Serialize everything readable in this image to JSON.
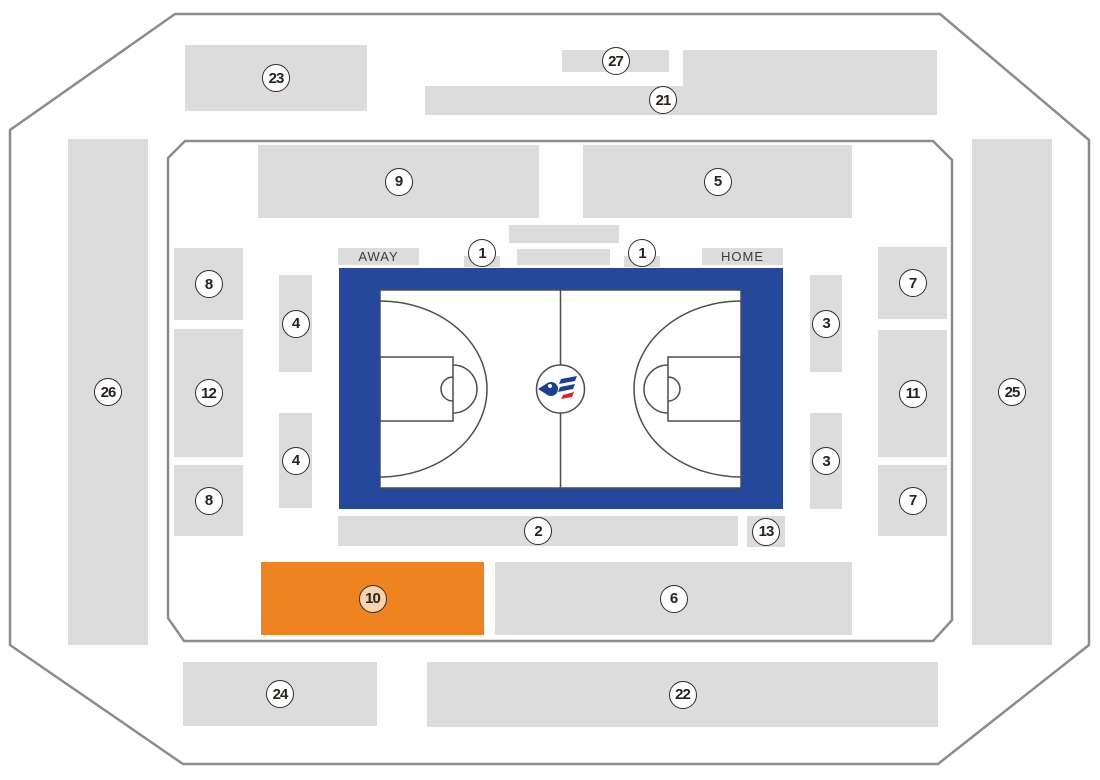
{
  "title": "Arena seating map",
  "labels": {
    "away": "AWAY",
    "home": "HOME"
  },
  "colors": {
    "section": "#dcdcdc",
    "highlight": "#ef8320",
    "boundary": "#8c8c8c",
    "court_border": "#26489c",
    "court_line": "#4d4d4d",
    "badge_border": "#362b27",
    "badge_text": "#2b211e",
    "badge_fill": "#ffffff",
    "badge_fill_highlight": "#f6d4ae",
    "tab_text": "#3b3b3b",
    "logo_blue": "#1c3f94",
    "logo_red": "#d5232e"
  },
  "sections": [
    {
      "id": "23",
      "label": "23",
      "x": 185,
      "y": 45,
      "w": 182,
      "h": 66
    },
    {
      "id": "27",
      "label": "27",
      "x": 562,
      "y": 50,
      "w": 107,
      "h": 22
    },
    {
      "id": "deck-top-right",
      "label": null,
      "x": 683,
      "y": 50,
      "w": 254,
      "h": 36
    },
    {
      "id": "21",
      "label": "21",
      "x": 425,
      "y": 86,
      "w": 512,
      "h": 29,
      "lx": 663,
      "ly": 100
    },
    {
      "id": "9",
      "label": "9",
      "x": 258,
      "y": 145,
      "w": 281,
      "h": 73
    },
    {
      "id": "5",
      "label": "5",
      "x": 583,
      "y": 145,
      "w": 269,
      "h": 73
    },
    {
      "id": "26",
      "label": "26",
      "x": 68,
      "y": 139,
      "w": 80,
      "h": 506
    },
    {
      "id": "25",
      "label": "25",
      "x": 972,
      "y": 139,
      "w": 80,
      "h": 506
    },
    {
      "id": "8-upper",
      "label": "8",
      "x": 174,
      "y": 248,
      "w": 69,
      "h": 72
    },
    {
      "id": "12",
      "label": "12",
      "x": 174,
      "y": 329,
      "w": 69,
      "h": 128
    },
    {
      "id": "8-lower",
      "label": "8",
      "x": 174,
      "y": 465,
      "w": 69,
      "h": 71
    },
    {
      "id": "4-upper",
      "label": "4",
      "x": 279,
      "y": 275,
      "w": 33,
      "h": 97
    },
    {
      "id": "4-lower",
      "label": "4",
      "x": 279,
      "y": 413,
      "w": 33,
      "h": 95
    },
    {
      "id": "3-upper",
      "label": "3",
      "x": 810,
      "y": 275,
      "w": 32,
      "h": 97
    },
    {
      "id": "3-lower",
      "label": "3",
      "x": 810,
      "y": 413,
      "w": 32,
      "h": 96
    },
    {
      "id": "7-upper",
      "label": "7",
      "x": 878,
      "y": 247,
      "w": 69,
      "h": 72
    },
    {
      "id": "11",
      "label": "11",
      "x": 878,
      "y": 330,
      "w": 69,
      "h": 127
    },
    {
      "id": "7-lower",
      "label": "7",
      "x": 878,
      "y": 465,
      "w": 69,
      "h": 71
    },
    {
      "id": "bar-upper-center",
      "label": null,
      "x": 509,
      "y": 225,
      "w": 110,
      "h": 18
    },
    {
      "id": "bar-lower-center",
      "label": null,
      "x": 517,
      "y": 249,
      "w": 93,
      "h": 16
    },
    {
      "id": "1-away",
      "label": "1",
      "x": 464,
      "y": 256,
      "w": 36,
      "h": 11,
      "ly": 253
    },
    {
      "id": "1-home",
      "label": "1",
      "x": 624,
      "y": 256,
      "w": 36,
      "h": 11,
      "ly": 253
    },
    {
      "id": "2",
      "label": "2",
      "x": 338,
      "y": 516,
      "w": 400,
      "h": 30
    },
    {
      "id": "13",
      "label": "13",
      "x": 747,
      "y": 516,
      "w": 38,
      "h": 31
    },
    {
      "id": "10",
      "label": "10",
      "x": 261,
      "y": 562,
      "w": 223,
      "h": 73,
      "highlight": true
    },
    {
      "id": "6",
      "label": "6",
      "x": 495,
      "y": 562,
      "w": 357,
      "h": 73
    },
    {
      "id": "24",
      "label": "24",
      "x": 183,
      "y": 662,
      "w": 194,
      "h": 64
    },
    {
      "id": "22",
      "label": "22",
      "x": 427,
      "y": 662,
      "w": 511,
      "h": 65
    }
  ]
}
